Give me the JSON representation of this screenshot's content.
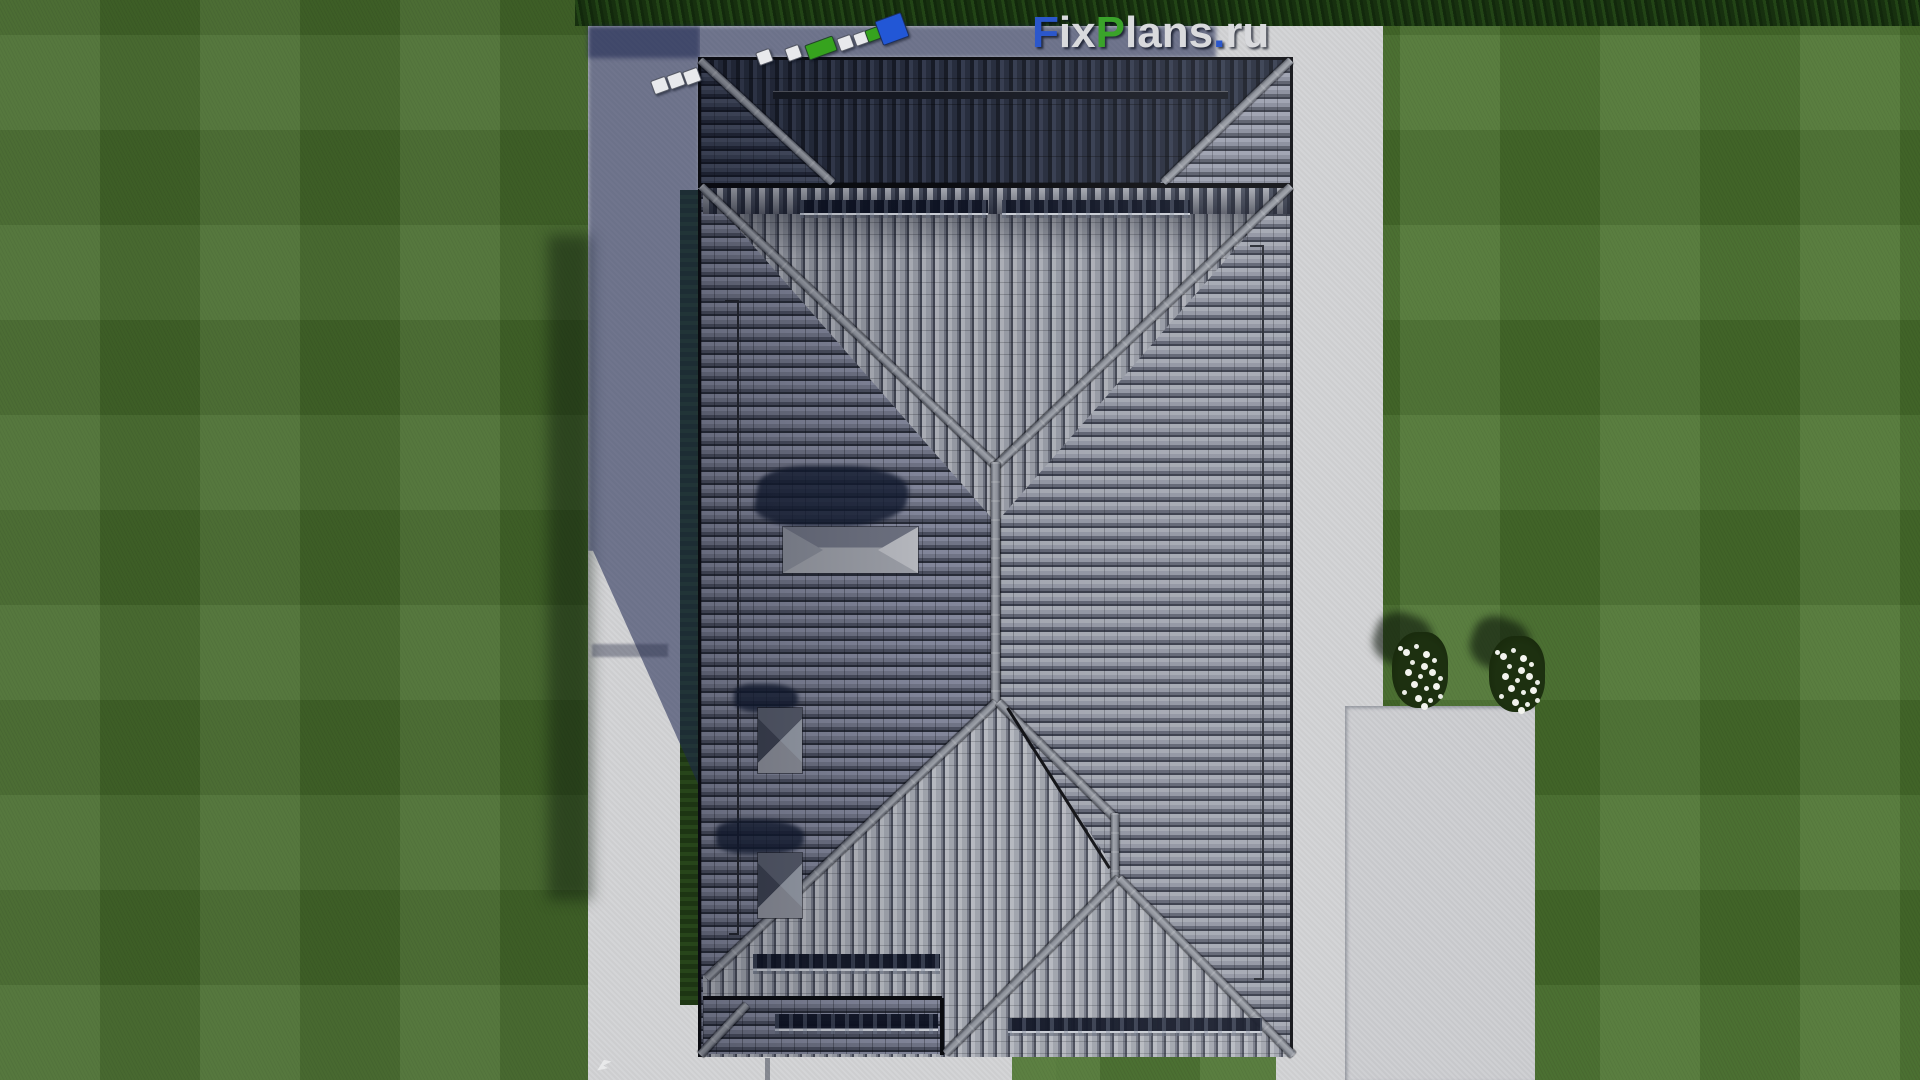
{
  "watermark": {
    "text": "FixPlans.ru",
    "letters": [
      {
        "ch": "F",
        "color": "#2b57cb"
      },
      {
        "ch": "i",
        "color": "#d9dadd"
      },
      {
        "ch": "x",
        "color": "#d9dadd"
      },
      {
        "ch": "P",
        "color": "#3aa32a"
      },
      {
        "ch": "l",
        "color": "#d9dadd"
      },
      {
        "ch": "a",
        "color": "#d9dadd"
      },
      {
        "ch": "n",
        "color": "#d9dadd"
      },
      {
        "ch": "s",
        "color": "#d9dadd"
      },
      {
        "ch": ".",
        "color": "#2b57cb"
      },
      {
        "ch": "r",
        "color": "#d9dadd"
      },
      {
        "ch": "u",
        "color": "#d9dadd"
      }
    ]
  },
  "logo_chain": {
    "squares": [
      {
        "x": 652,
        "y": 78,
        "w": 14,
        "h": 13,
        "color": "#e8e9ec"
      },
      {
        "x": 668,
        "y": 73,
        "w": 14,
        "h": 13,
        "color": "#e8e9ec"
      },
      {
        "x": 684,
        "y": 69,
        "w": 14,
        "h": 13,
        "color": "#e8e9ec"
      },
      {
        "x": 757,
        "y": 50,
        "w": 13,
        "h": 12,
        "color": "#e8e9ec"
      },
      {
        "x": 786,
        "y": 46,
        "w": 13,
        "h": 12,
        "color": "#e8e9ec"
      },
      {
        "x": 806,
        "y": 40,
        "w": 28,
        "h": 14,
        "color": "#36a31e"
      },
      {
        "x": 838,
        "y": 36,
        "w": 13,
        "h": 12,
        "color": "#e8e9ec"
      },
      {
        "x": 854,
        "y": 32,
        "w": 12,
        "h": 11,
        "color": "#e8e9ec"
      },
      {
        "x": 866,
        "y": 28,
        "w": 12,
        "h": 11,
        "color": "#36a31e"
      },
      {
        "x": 878,
        "y": 16,
        "w": 26,
        "h": 24,
        "color": "#2257d6"
      }
    ]
  },
  "palette": {
    "grass": "#4a712f",
    "hedge": "#1b3512",
    "pavement_sunlit": "#d4d5d7",
    "pavement_shadow": "#6d7288",
    "roof_tile_light": "#a2a6b0",
    "roof_tile_dark": "#343846",
    "roof_shadow_slope": "#1e2433",
    "ridge_gray": "#9ca0a8",
    "chimney_shadow": "#1a2234",
    "flower_white": "#f2f3ee"
  },
  "scene": {
    "type": "aerial-3d-render",
    "subject": "hip roof of a single-family house, top-down view",
    "elements": [
      "lawn-with-mowing-stripes",
      "boxwood-hedge",
      "concrete-walkway",
      "rear-patio",
      "main-hip-roof",
      "garage-roof-section",
      "roof-ridges-and-valleys",
      "snow-guard-rails",
      "lightning-conductor-wires",
      "large-chimney-cap",
      "two-small-chimney-caps",
      "cast-shadows",
      "two-white-flower-bushes",
      "fixplans-watermark",
      "colored-logo-chain"
    ]
  }
}
